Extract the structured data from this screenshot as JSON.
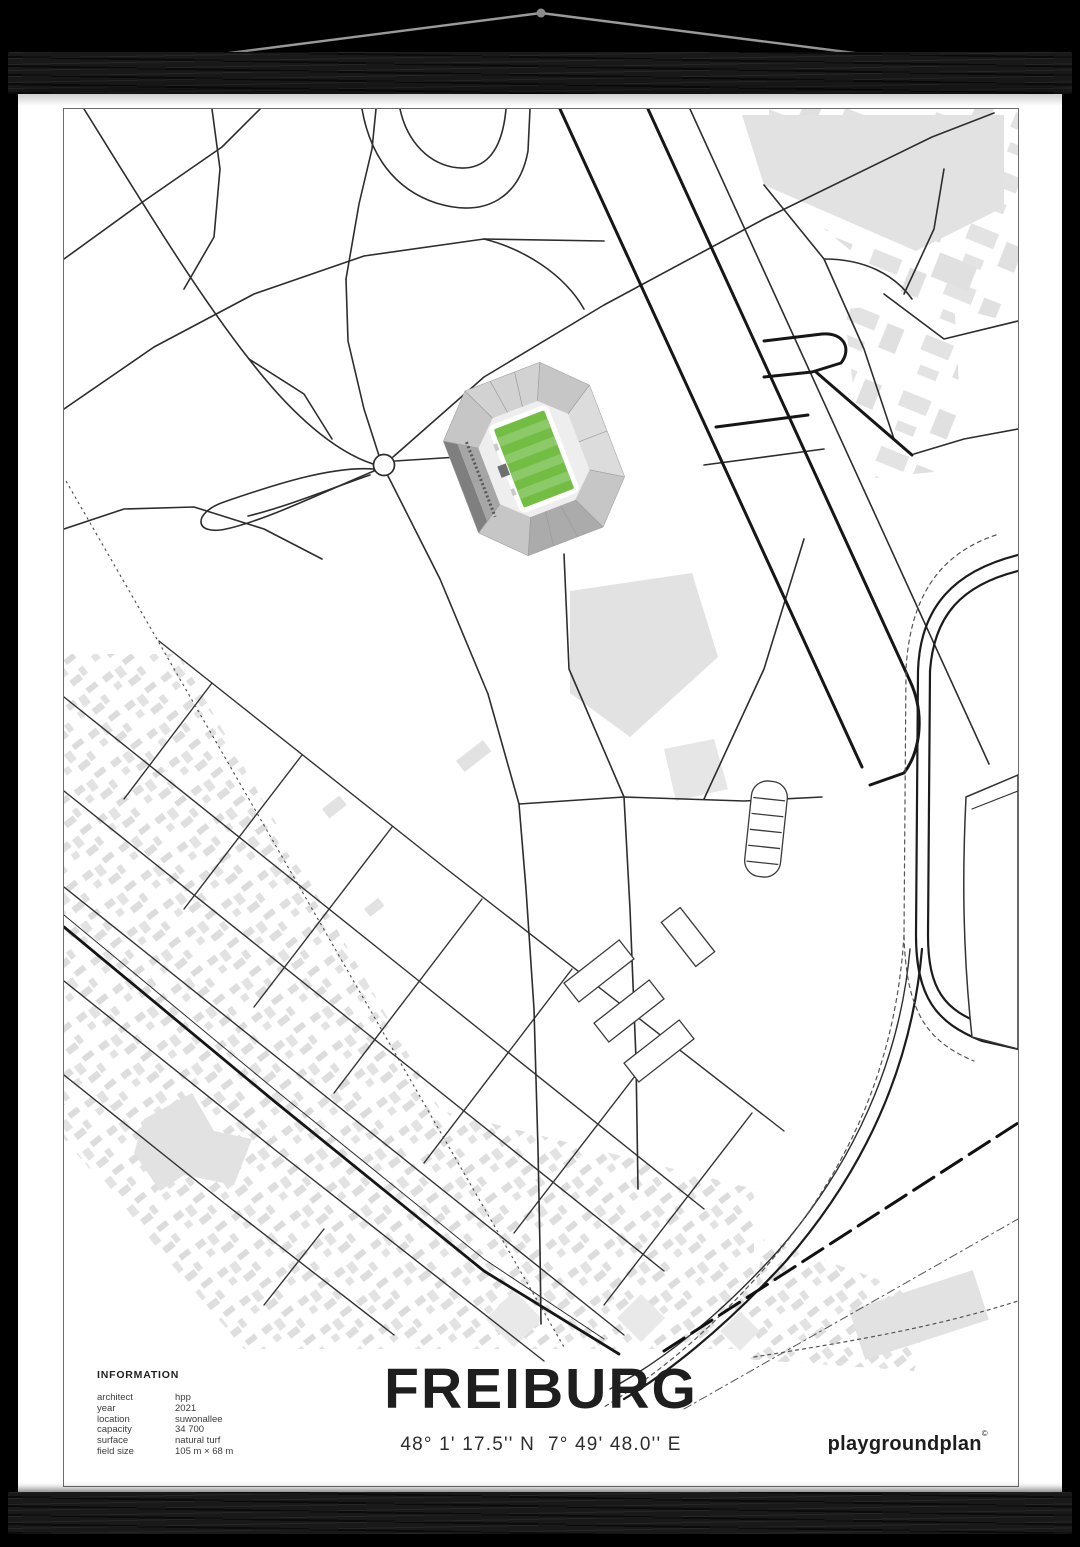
{
  "poster": {
    "title": "FREIBURG",
    "coordinates": "48° 1' 17.5'' N  7° 49' 48.0'' E",
    "info": {
      "heading": "INFORMATION",
      "rows": [
        {
          "label": "architect",
          "value": "hpp"
        },
        {
          "label": "year",
          "value": "2021"
        },
        {
          "label": "location",
          "value": "suwonallee"
        },
        {
          "label": "capacity",
          "value": "34 700"
        },
        {
          "label": "surface",
          "value": "natural turf"
        },
        {
          "label": "field size",
          "value": "105 m × 68 m"
        }
      ]
    },
    "brand": {
      "logo_text": "playgroundplan",
      "logo_mark": "©"
    }
  },
  "map": {
    "subject": "Europa-Park Stadion Freiburg street map",
    "pitch_color": "#74bd45",
    "pitch_stripe_color": "#8cc968",
    "stand_color": "#b0b0b0",
    "road_color": "#2d2d2d",
    "major_road_color": "#161616",
    "building_color": "#e4e4e4",
    "background": "#ffffff"
  },
  "mockup": {
    "bar_color": "#191919",
    "cord_color": "#9a9a9a",
    "background": "#000000"
  }
}
